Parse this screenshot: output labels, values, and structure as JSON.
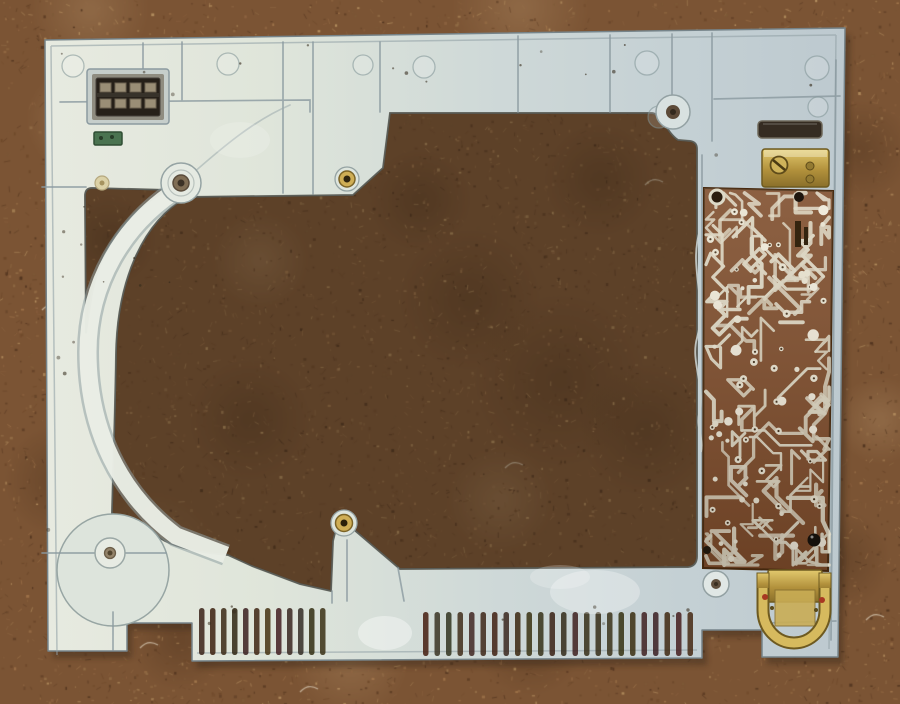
{
  "scene": {
    "description": "photograph of a light gray plastic chassis frame lying on brown carpet",
    "parts": [
      "carpet-background",
      "chassis-frame",
      "connector-socket",
      "green-pcb-fragment",
      "arc-band",
      "screw-bosses",
      "vent-slots",
      "gusset",
      "top-slot-opening",
      "circuit-board",
      "jumper-wire",
      "brass-bracket",
      "brass-d-clip",
      "stain-smudges"
    ]
  },
  "colors": {
    "carpet_base": "#7b5434",
    "carpet_light": "#b08457",
    "carpet_dark": "#3e2916",
    "plastic_light": "#e7eae0",
    "plastic_dark": "#bdc9cf",
    "plastic_groove": "#8b9aa0",
    "pcb_copper": "#7a4a2b",
    "pcb_trace": "#ddd9c7",
    "brass": "#cfae55",
    "slot_dark_rgb": [
      58,
      40,
      24
    ],
    "connector_dark": "#262019",
    "green_fragment": "#4a7350"
  },
  "carpet": {
    "speckle_count": 4200,
    "fiber_count": 2600,
    "palette": [
      "#8f6542",
      "#6b4628",
      "#a87c50",
      "#5a3a22",
      "#c09b68",
      "#4a2f1c",
      "#96714a",
      "#7d5a38"
    ]
  },
  "vents": {
    "left": {
      "count": 12,
      "x0": 199,
      "pitch": 11.0,
      "width": 5.5,
      "y": 608,
      "height": 47
    },
    "right": {
      "count": 24,
      "x0": 423,
      "pitch": 11.5,
      "width": 5.5,
      "y": 612,
      "height": 44
    }
  },
  "pcb": {
    "x": 706,
    "y": 193,
    "w": 123,
    "h": 372,
    "trace_count": 85,
    "pad_count": 55,
    "solder_blob_count": 14
  },
  "dirt_speck_count": 36
}
